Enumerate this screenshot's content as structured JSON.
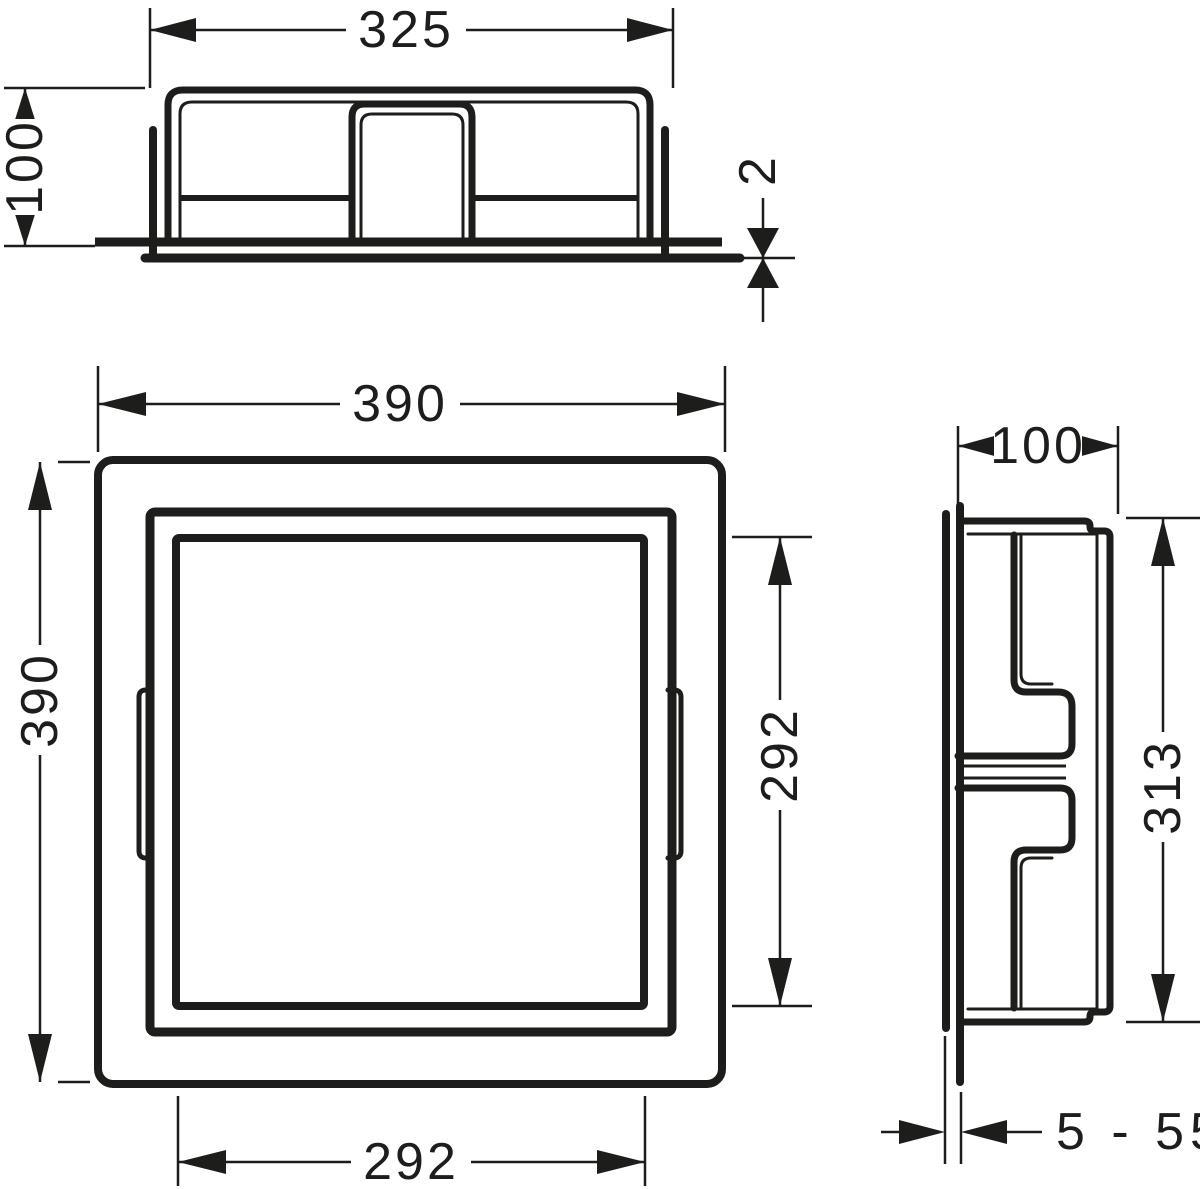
{
  "colors": {
    "line": "#1d1d1b",
    "background": "#ffffff"
  },
  "views": {
    "top": {
      "dims": {
        "width": "325",
        "depth": "100",
        "frame_thickness": "2"
      }
    },
    "front": {
      "dims": {
        "outer_width": "390",
        "outer_height": "390",
        "opening_width": "292",
        "opening_height": "292"
      }
    },
    "side": {
      "dims": {
        "depth": "100",
        "box_height": "313",
        "install_depth_range": "5 - 55"
      }
    }
  }
}
